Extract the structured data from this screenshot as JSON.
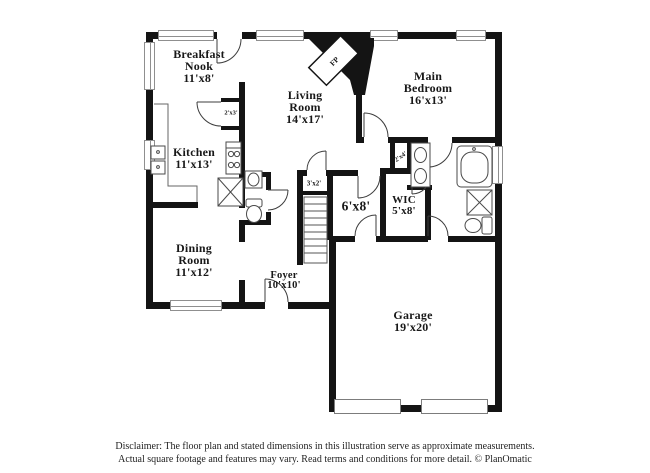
{
  "rooms": [
    {
      "name": "Breakfast\nNook",
      "dims": "11'x8'"
    },
    {
      "name": "Living\nRoom",
      "dims": "14'x17'"
    },
    {
      "name": "Main\nBedroom",
      "dims": "16'x13'"
    },
    {
      "name": "Kitchen",
      "dims": "11'x13'"
    },
    {
      "name": "Dining\nRoom",
      "dims": "11'x12'"
    },
    {
      "name": "Foyer",
      "dims": "10'x10'"
    },
    {
      "name": "Garage",
      "dims": "19'x20'"
    },
    {
      "name": "WIC",
      "dims": "5'x8'"
    },
    {
      "name": "",
      "dims": "6'x8'"
    }
  ],
  "small_labels": {
    "pantry": "2'x3'",
    "hall_closet": "3'x2'",
    "linen_closet": "2'x4'",
    "fireplace": "FP"
  },
  "disclaimer": {
    "line1": "Disclaimer: The floor plan and stated dimensions in this illustration serve as approximate measurements.",
    "line2": "Actual square footage and features may vary. Read terms and conditions for more detail. © PlanOmatic"
  },
  "colors": {
    "wall": "#141414",
    "fixture_line": "#4a4a4a",
    "window_line": "#8f8f8f"
  }
}
